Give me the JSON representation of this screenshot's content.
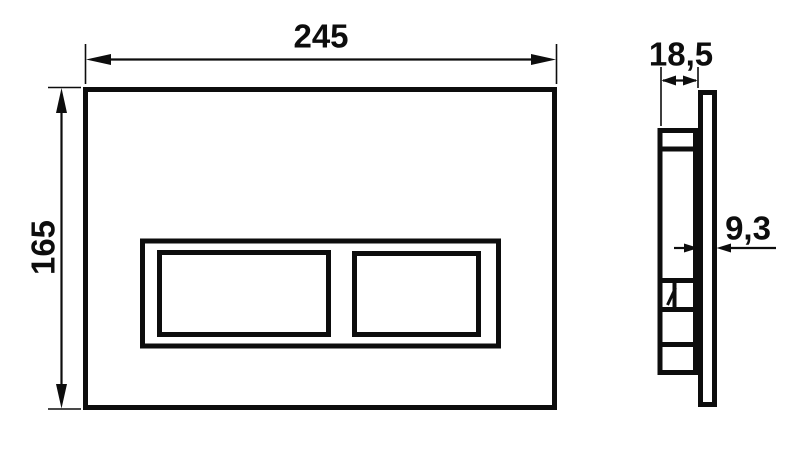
{
  "drawing": {
    "type": "technical-dimension-drawing",
    "background_color": "#ffffff",
    "line_color": "#0d0d0d",
    "front_view": {
      "description": "flush plate front view with two button openings",
      "width_dim": "245",
      "height_dim": "165"
    },
    "side_view": {
      "description": "flush plate side profile with mounting mechanism",
      "depth_dim": "18,5",
      "plate_thickness_dim": "9,3"
    }
  }
}
